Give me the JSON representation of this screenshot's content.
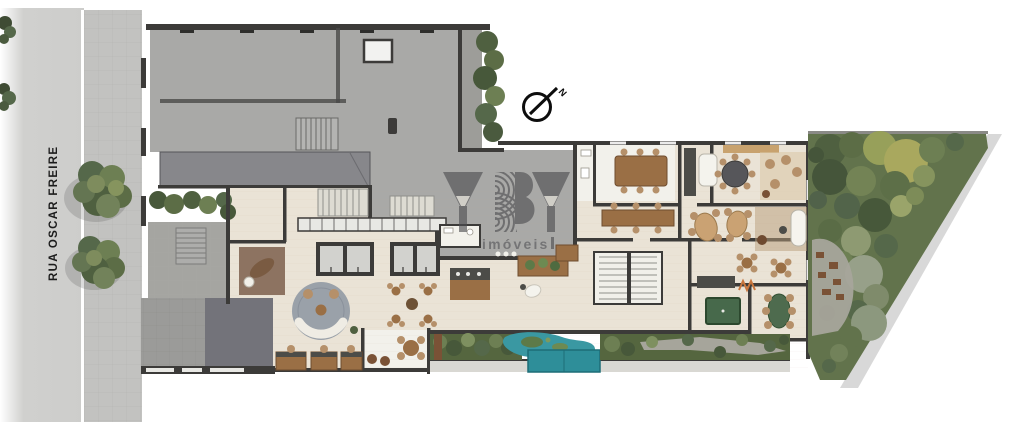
{
  "plan": {
    "street_label": "RUA OSCAR FREIRE",
    "north": {
      "label": "N"
    },
    "watermark": {
      "title": "YBY",
      "subtitle": "imóveis"
    }
  },
  "colors": {
    "street": "#d3d3d1",
    "sidewalk": "#c2c2c0",
    "curb": "#ffffff",
    "roof": "#a9a9a7",
    "canopy": "#87878b",
    "wall": "#3c3b39",
    "floor": "#eae3d6",
    "floorlight": "#f2f1eb",
    "wood": "#9a6f45",
    "wooddark": "#7a5236",
    "chair": "#b5906a",
    "counter": "#4c4c48",
    "rug": "#9aa1a9",
    "garden": "#62734c",
    "water": "#3a98a2",
    "pool": "#2e8e99",
    "gravel": "#a6a59b",
    "watermark": "#4c4c50",
    "text": "#1c1c1c"
  }
}
